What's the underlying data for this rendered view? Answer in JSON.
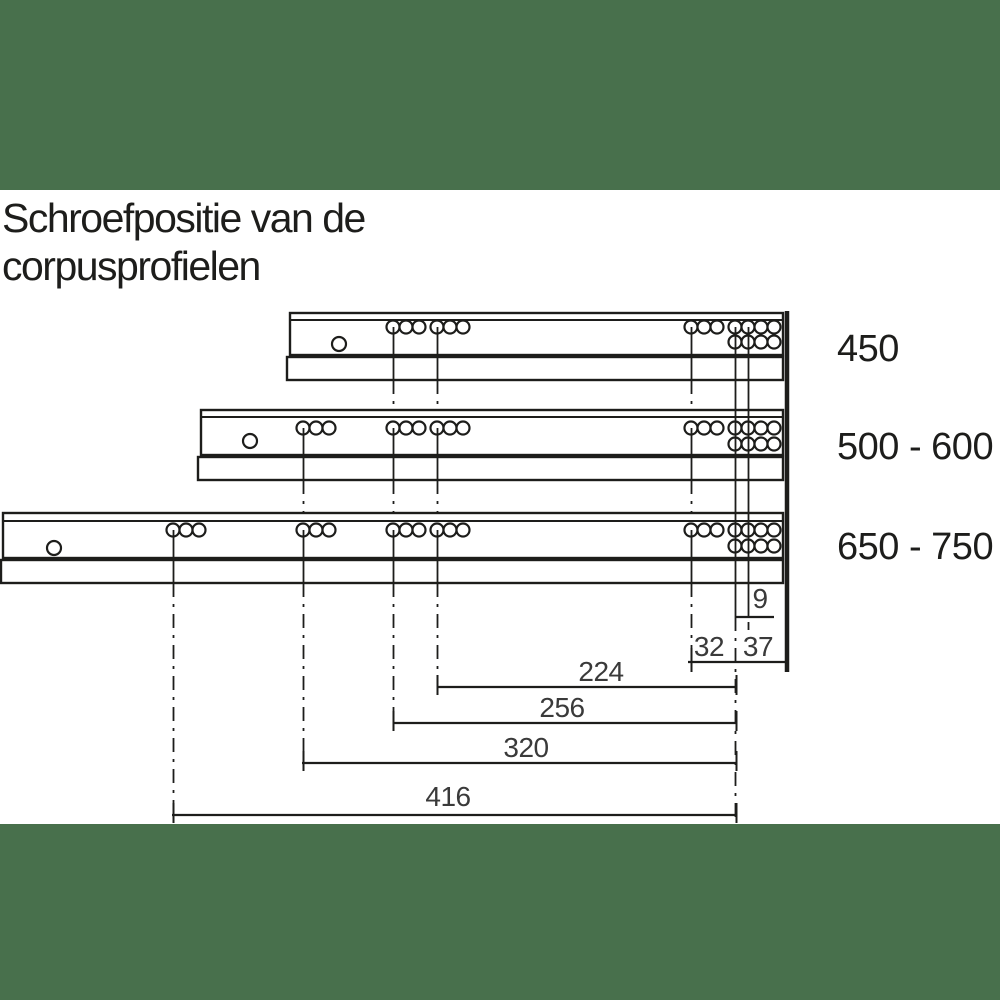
{
  "title": {
    "line1": "Schroefpositie van de",
    "line2": "corpusprofielen"
  },
  "profiles": [
    {
      "label": "450"
    },
    {
      "label": "500 - 600"
    },
    {
      "label": "650 - 750"
    }
  ],
  "dims": {
    "d9": "9",
    "d32": "32",
    "d37": "37",
    "d224": "224",
    "d256": "256",
    "d320": "320",
    "d416": "416"
  },
  "colors": {
    "band_green": "#48704C",
    "line": "#1d1d1b",
    "dim_text": "#3a3a3a",
    "background": "#ffffff"
  }
}
